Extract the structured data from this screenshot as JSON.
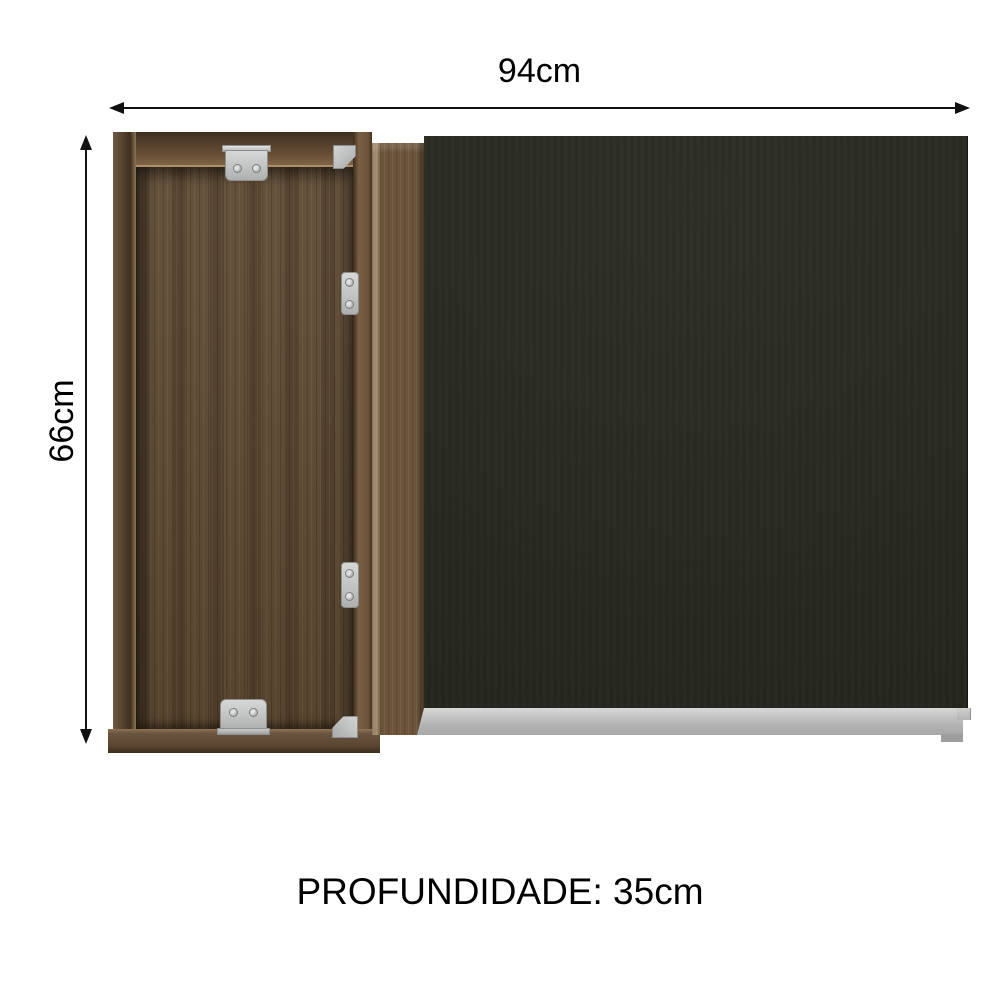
{
  "dimensions": {
    "width": {
      "label": "94cm"
    },
    "height": {
      "label": "66cm"
    },
    "depth": {
      "label": "PROFUNDIDADE: 35cm"
    }
  },
  "cabinet": {
    "hardware": {
      "hinge_plate_count": 4,
      "corner_bracket_count": 2,
      "screw_count": 8
    },
    "colors": {
      "wood": "#5e4a33",
      "wood_dark": "#45331f",
      "wood_light": "#8c7354",
      "door_black": "#262820",
      "rail_silver": "#b9bab9",
      "metal": "#c7c9c8",
      "arrow_black": "#111111",
      "background": "#ffffff"
    }
  }
}
